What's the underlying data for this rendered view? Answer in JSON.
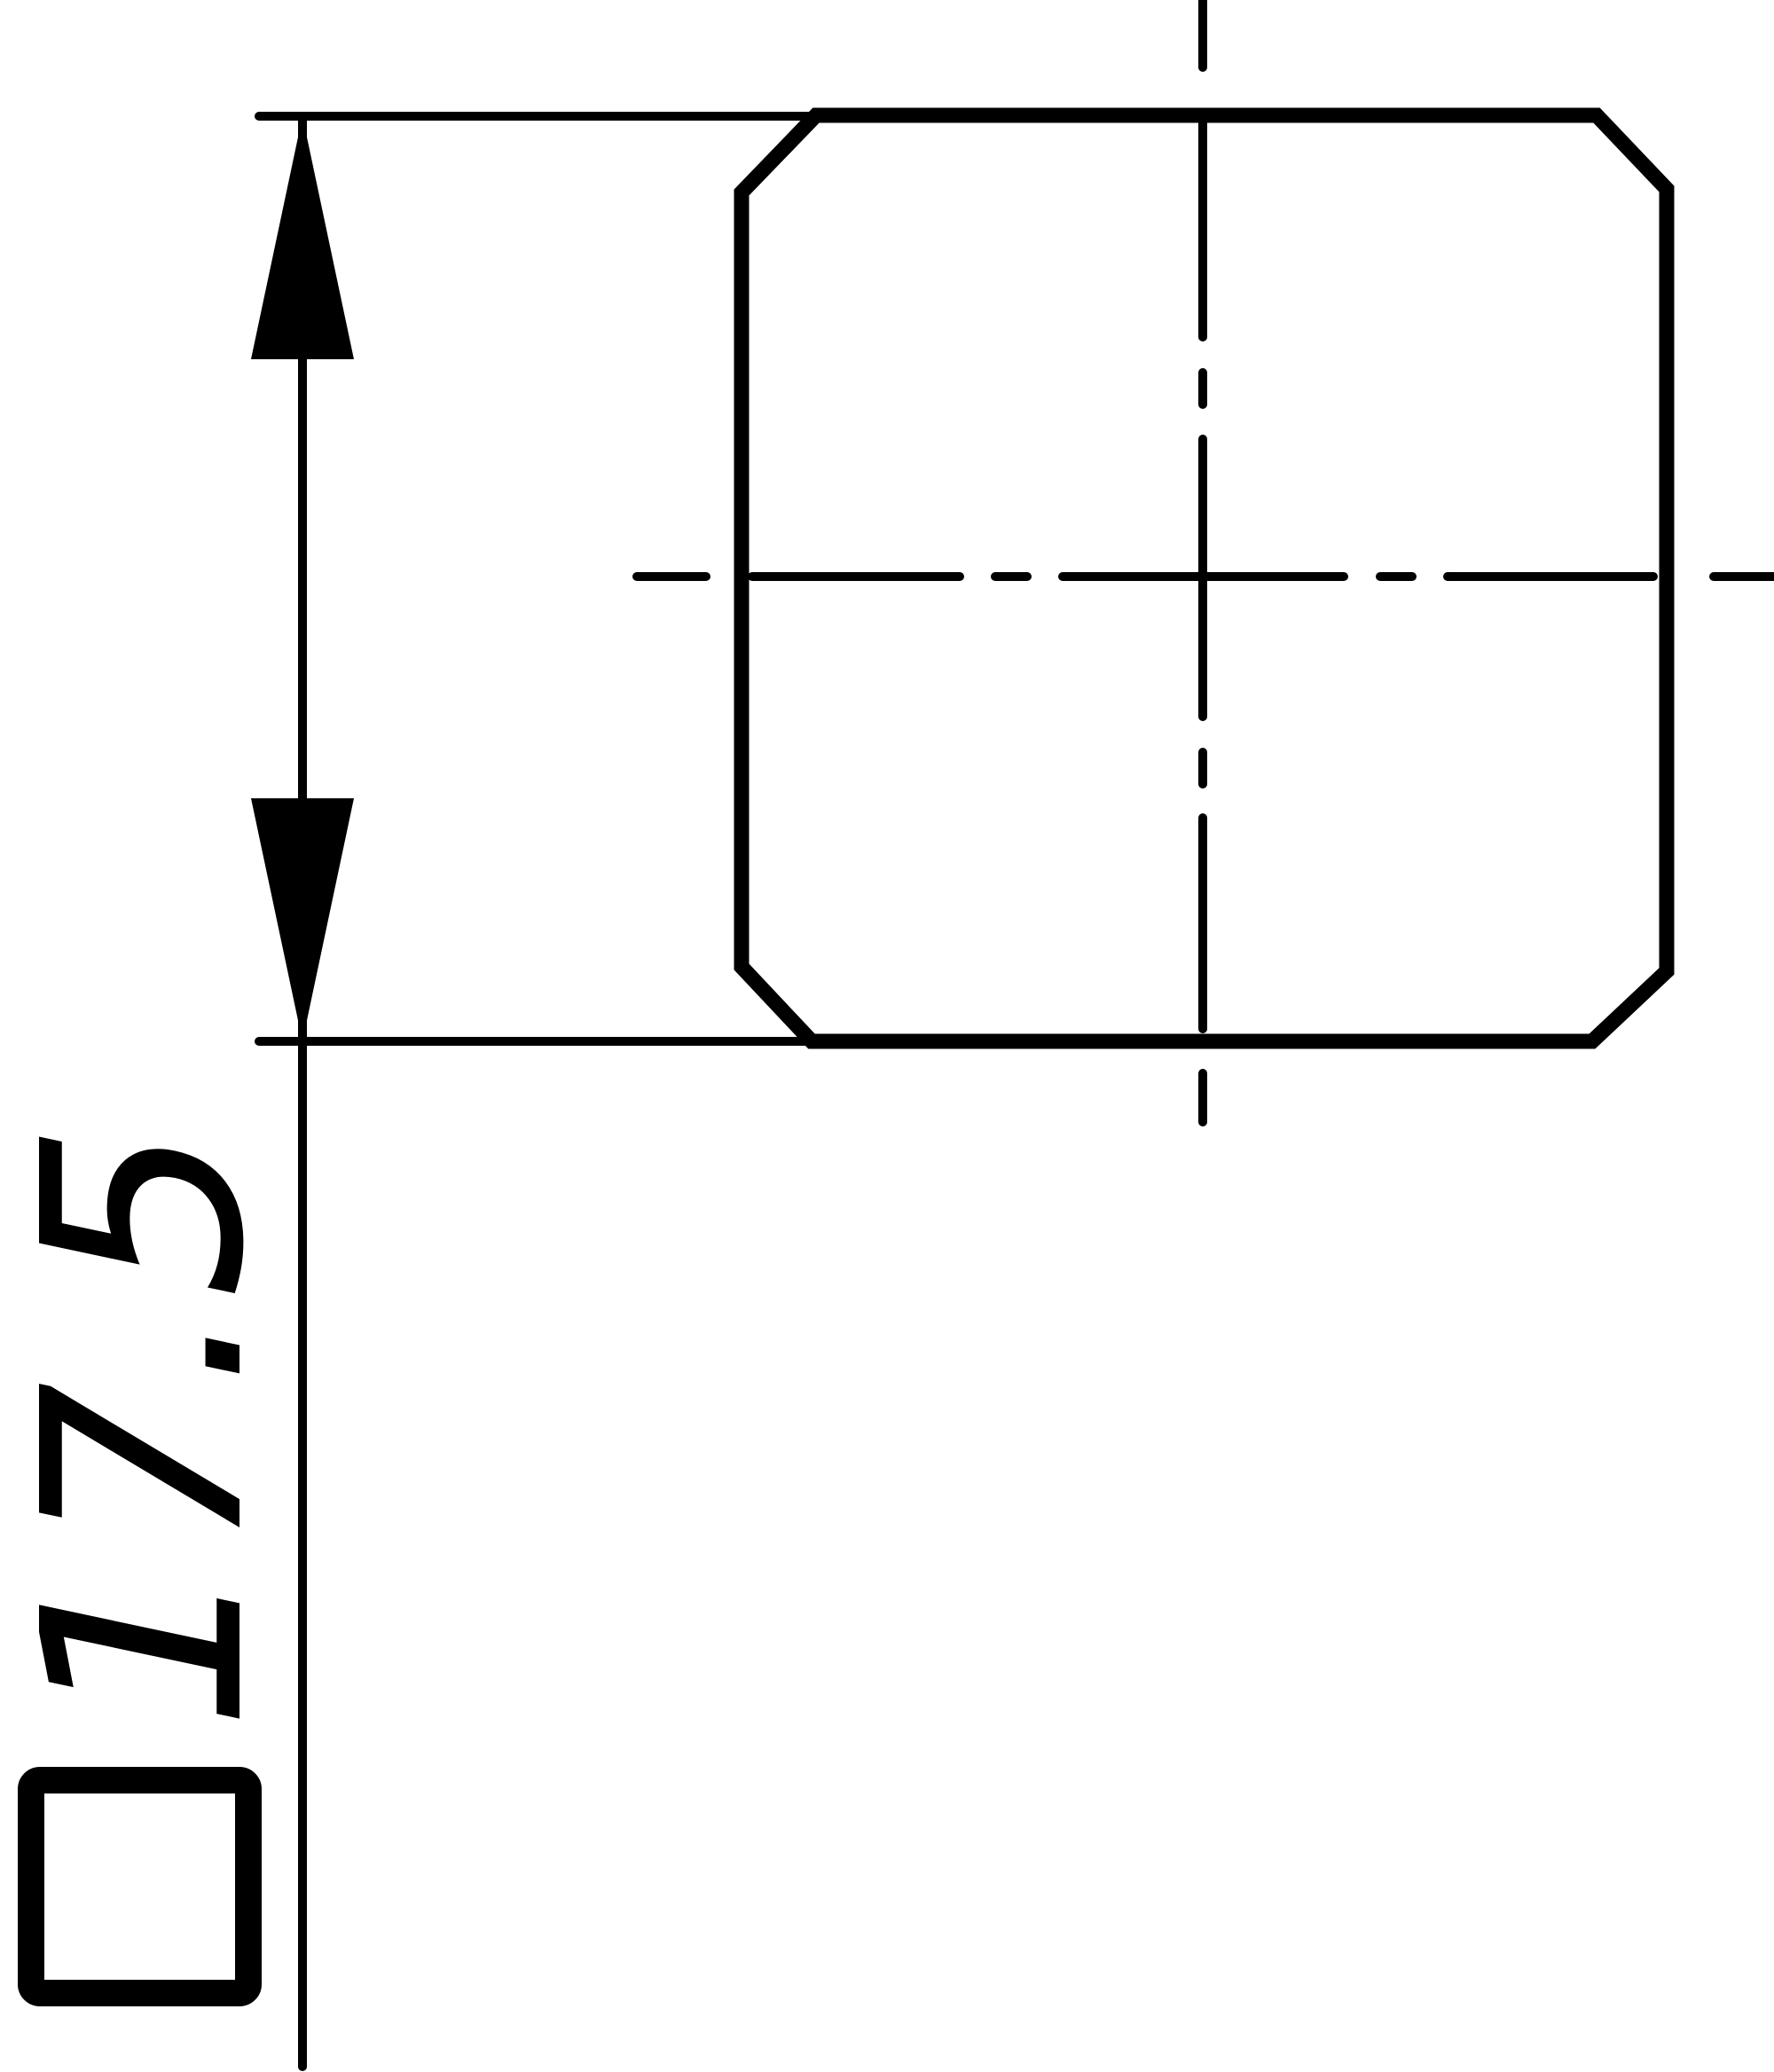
{
  "drawing": {
    "view": "end-view-square-part-with-chamfered-corners",
    "dimension": {
      "symbol": "□",
      "value": "17.5",
      "label": "□17.5"
    },
    "icons": {
      "arrowhead_up": "filled-triangle-arrowhead-up",
      "arrowhead_down": "filled-triangle-arrowhead-down",
      "square_symbol": "square-section-symbol"
    },
    "colors": {
      "line": "#000000",
      "background": "#ffffff"
    }
  }
}
